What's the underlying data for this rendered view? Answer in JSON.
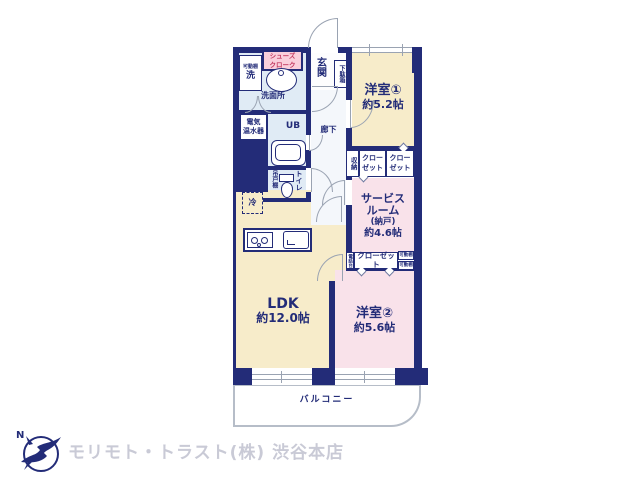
{
  "agency": {
    "name": "モリモト・トラスト(株) 渋谷本店",
    "compass_letter": "N"
  },
  "rooms": {
    "yoshitsu1": {
      "name": "洋室①",
      "area": "約5.2帖"
    },
    "yoshitsu2": {
      "name": "洋室②",
      "area": "約5.6帖"
    },
    "ldk": {
      "name": "LDK",
      "area": "約12.0帖"
    },
    "service_room": {
      "name_line1": "サービス",
      "name_line2": "ルーム",
      "name_line3": "(納戸)",
      "area": "約4.6帖"
    },
    "balcony": {
      "name": "バルコニー"
    },
    "genkan": {
      "name": "玄関"
    },
    "corridor": {
      "name": "廊下"
    },
    "washroom": {
      "name": "洗面所"
    },
    "bathroom": {
      "name": "UB"
    },
    "toilet": {
      "name": "トイレ"
    }
  },
  "fixtures": {
    "shoes_cloak": {
      "line1": "シューズ",
      "line2": "クローク"
    },
    "shoe_cabinet": "下駄箱",
    "movable_shelf": "可動棚",
    "washer": "洗",
    "water_heater": {
      "line1": "電気",
      "line2": "温水器"
    },
    "hanging_cupboard": "吊戸棚",
    "refrigerator": "冷",
    "storage": "収納",
    "closet_split": {
      "line1": "クロー",
      "line2": "ゼット"
    },
    "closet": "クローゼット",
    "phone_stand": "電話台"
  },
  "colors": {
    "wall": "#232c78",
    "western_room": "#f7ecca",
    "pink_room": "#f9e2ea",
    "wet_area": "#e0ebf5",
    "accent_pink": "#f9cfdb",
    "accent_text": "#c23a60",
    "logo_text": "#c9cad6"
  }
}
